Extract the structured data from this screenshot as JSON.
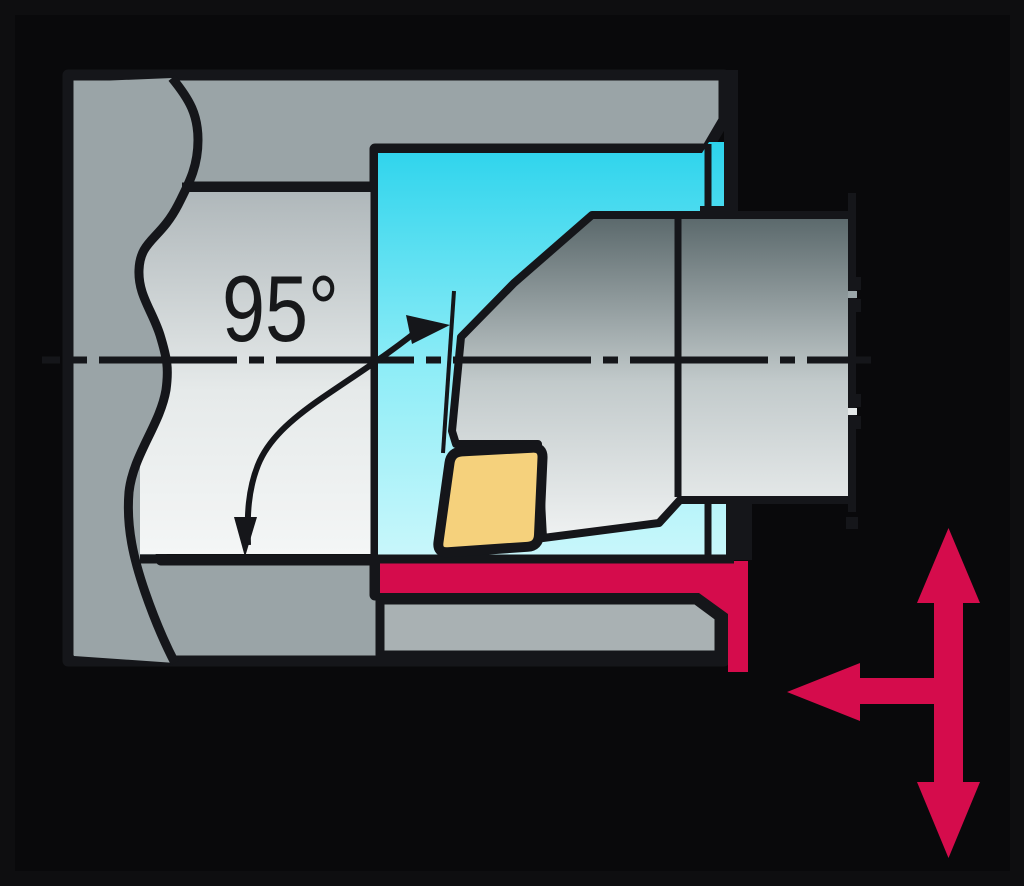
{
  "diagram": {
    "type": "technical-illustration",
    "subject": "internal turning (boring) operation, section view",
    "angle_label": "95°",
    "parts": [
      "workpiece-cross-section",
      "bore-cavity",
      "boring-bar-shank",
      "cutting-insert",
      "machined-surface-highlight",
      "entering-angle-arc",
      "centerline",
      "feed-direction-arrows"
    ],
    "colors": {
      "background": "#0E0E10",
      "workpiece_gray": "#9AA4A7",
      "inner_wall_gray": "#A9B1B3",
      "bore_cyan": "#2CD3EC",
      "tool_gray_dark": "#586669",
      "tool_gray_light": "#F3F5F5",
      "insert_yellow": "#F5D17C",
      "highlight_red": "#D50C4C",
      "outline_black": "#15161A"
    }
  }
}
